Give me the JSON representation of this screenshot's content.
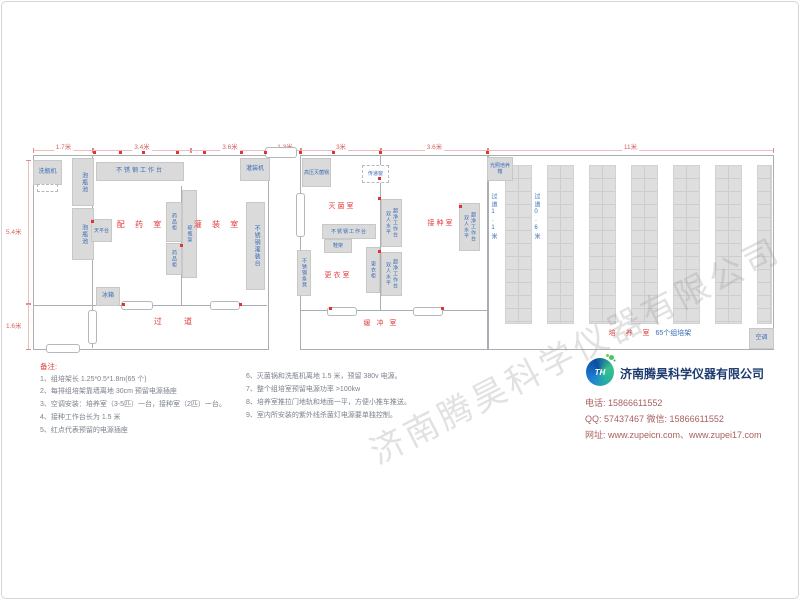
{
  "watermark": "济南腾昊科学仪器有限公司",
  "dimensions": {
    "top": [
      "1.7米",
      "3.4米",
      "3.6米",
      "1.3米",
      "3米",
      "3.6米",
      "11米"
    ],
    "left": [
      "5.4米",
      "1.6米"
    ]
  },
  "rooms": {
    "dispensing": "配 药 室",
    "filling": "灌 装 室",
    "corridor": "过    道",
    "sterilizing": "灭菌室",
    "changing": "更衣室",
    "inoculation": "接种室",
    "buffer": "缓 冲 室",
    "culture": "培 养 室",
    "culture_suffix": "65个组培架"
  },
  "equipment": {
    "bottle_washer": "洗瓶机",
    "soaking_pool": "泡瓶池",
    "ss_worktable": "不锈钢工作台",
    "balance_table": "天平台",
    "fridge": "冰箱",
    "medicine_cabinet": "药品柜",
    "bottle_rack": "晾瓶架",
    "filling_machine": "灌装机",
    "ss_filling_table": "不锈钢灌装台",
    "autoclave": "高压灭菌锅",
    "transfer_window": "传递窗",
    "shoe_rack": "鞋架",
    "locker": "更衣柜",
    "ss_bench": "不锈钢条凳",
    "clean_bench_line1": "双人水平",
    "clean_bench_line2": "超净工作台",
    "light_incubator": "光照培养箱",
    "air_conditioner": "空调",
    "aisle_wide": "过道1.1米",
    "aisle_narrow": "过道0.6米"
  },
  "notes": {
    "title": "备注:",
    "left": [
      "1、组培架长 1.25*0.5*1.8m(65 个)",
      "2、每排组培架靠墙离地 30cm 预留电源插座",
      "3、空调安装：培养室（3-5匹）一台，接种室（2匹）一台。",
      "4、接种工作台长为 1.5 米",
      "5、红点代表预留的电源插座"
    ],
    "right": [
      "6、灭菌锅和洗瓶机离地 1.5 米，预留 380v 电源。",
      "7、整个组培室预留电源功率 >100kw",
      "8、培养室推拉门地轨和地面一平，方便小推车推送。",
      "9、室内所安装的紫外线杀菌灯电源要单独控制。"
    ]
  },
  "company": {
    "logo_text": "TH",
    "name": "济南腾昊科学仪器有限公司",
    "phone": "电话: 15866611552",
    "qq_wechat": "QQ: 57437467  微信: 15866611552",
    "website": "网址: www.zupeicn.com、www.zupei17.com"
  },
  "colors": {
    "accent_red": "#e03c3c",
    "label_blue": "#3a6cb5",
    "company_navy": "#1d3b6f"
  }
}
